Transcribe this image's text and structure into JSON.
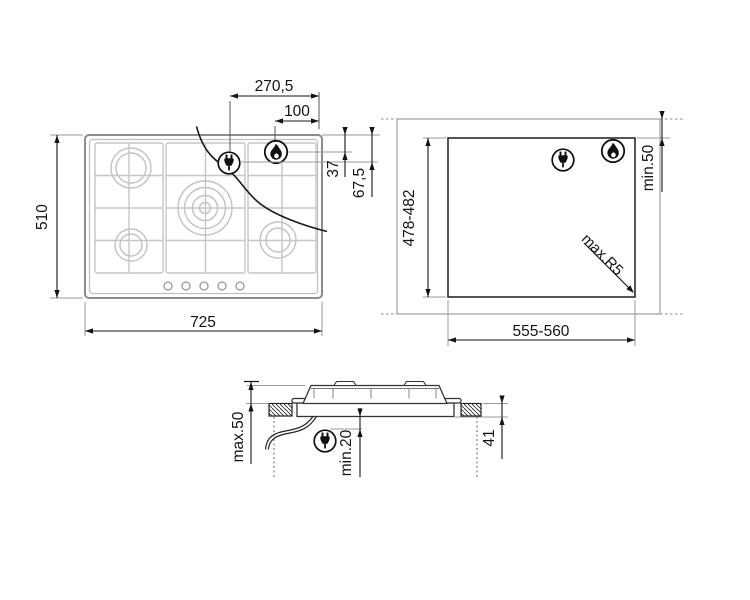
{
  "diagram": {
    "plan_view": {
      "width": "725",
      "height": "510",
      "plug_offset_from_right": "270,5",
      "burner_offset_from_right": "100",
      "burner_offset_from_top": "37",
      "plug_offset_from_top": "67,5"
    },
    "cutout_view": {
      "cutout_width": "555-560",
      "cutout_height": "478-482",
      "rear_clearance": "min.50",
      "corner_radius": "max.R5"
    },
    "side_view": {
      "max_above": "max.50",
      "clearance_below": "min.20",
      "depth_below_worktop": "41"
    },
    "icons": {
      "plug": "plug-icon",
      "flame": "gas-flame-icon"
    },
    "colors": {
      "dimension_line": "#141414",
      "hob_outline": "#8c8c8c",
      "hob_detail": "#c6c6c6",
      "reference_line": "#9a9a9a",
      "worktop_line": "#b0b0b0"
    }
  }
}
